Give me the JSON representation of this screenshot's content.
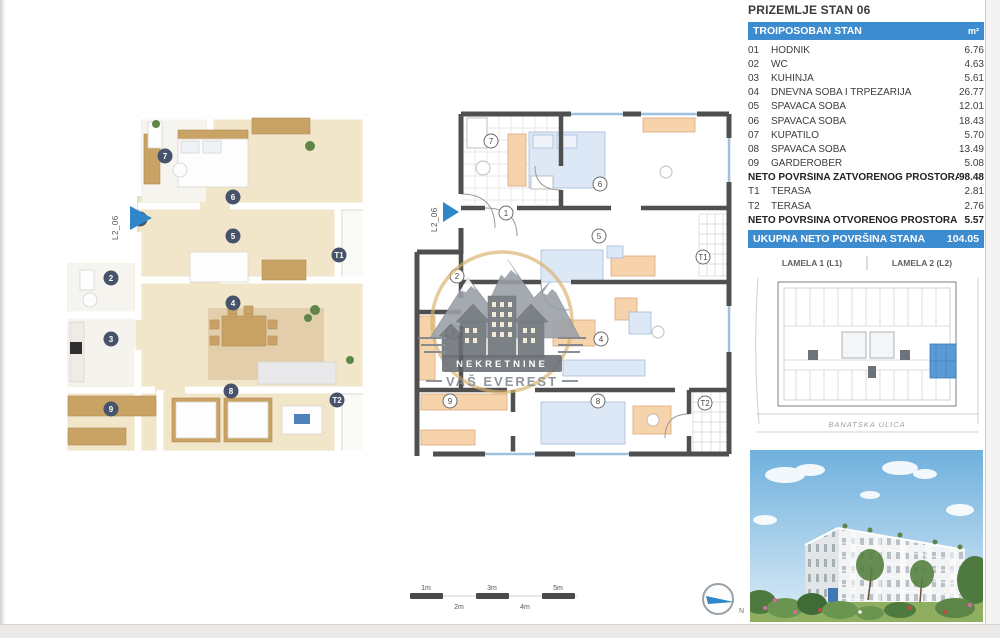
{
  "page_title": "PRIZEMLJE STAN 06",
  "colors": {
    "accent_blue": "#3d8cd0",
    "highlight_blue": "#5b9bd5",
    "wall_gray": "#4f4f4f",
    "gold": "#d9b26b"
  },
  "area_table": {
    "header_label": "TROIPOSOBAN STAN",
    "header_unit": "m²",
    "rows": [
      {
        "no": "01",
        "name": "HODNIK",
        "value": "6.76"
      },
      {
        "no": "02",
        "name": "WC",
        "value": "4.63"
      },
      {
        "no": "03",
        "name": "KUHINJA",
        "value": "5.61"
      },
      {
        "no": "04",
        "name": "DNEVNA SOBA I TRPEZARIJA",
        "value": "26.77"
      },
      {
        "no": "05",
        "name": "SPAVAĆA SOBA",
        "value": "12.01"
      },
      {
        "no": "06",
        "name": "SPAVAĆA SOBA",
        "value": "18.43"
      },
      {
        "no": "07",
        "name": "KUPATILO",
        "value": "5.70"
      },
      {
        "no": "08",
        "name": "SPAVAĆA SOBA",
        "value": "13.49"
      },
      {
        "no": "09",
        "name": "GARDEROBER",
        "value": "5.08"
      }
    ],
    "subtotal_closed_label": "NETO POVRŠINA ZATVORENOG PROSTORA",
    "subtotal_closed_value": "98.48",
    "terrace_rows": [
      {
        "no": "T1",
        "name": "TERASA",
        "value": "2.81"
      },
      {
        "no": "T2",
        "name": "TERASA",
        "value": "2.76"
      }
    ],
    "subtotal_open_label": "NETO POVRŠINA OTVORENOG PROSTORA",
    "subtotal_open_value": "5.57",
    "total_label": "UKUPNA NETO POVRŠINA STANA",
    "total_value": "104.05"
  },
  "plans": {
    "entry_label": "L2_06",
    "room_markers": {
      "r1": "1",
      "r2": "2",
      "r3": "3",
      "r4": "4",
      "r5": "5",
      "r6": "6",
      "r7": "7",
      "r8": "8",
      "r9": "9",
      "t1": "T1",
      "t2": "T2"
    }
  },
  "watermark": {
    "line1": "NEKRETNINE",
    "line2": "VAŠ EVEREST"
  },
  "site_plan": {
    "lamela1": "LAMELA 1  (L1)",
    "lamela2": "LAMELA 2  (L2)",
    "street": "BANATSKA ULICA"
  },
  "scale_bar": {
    "m1": "1m",
    "m2": "2m",
    "m3": "3m",
    "m4": "4m",
    "m5": "5m"
  },
  "compass": {
    "north_label": "N"
  }
}
